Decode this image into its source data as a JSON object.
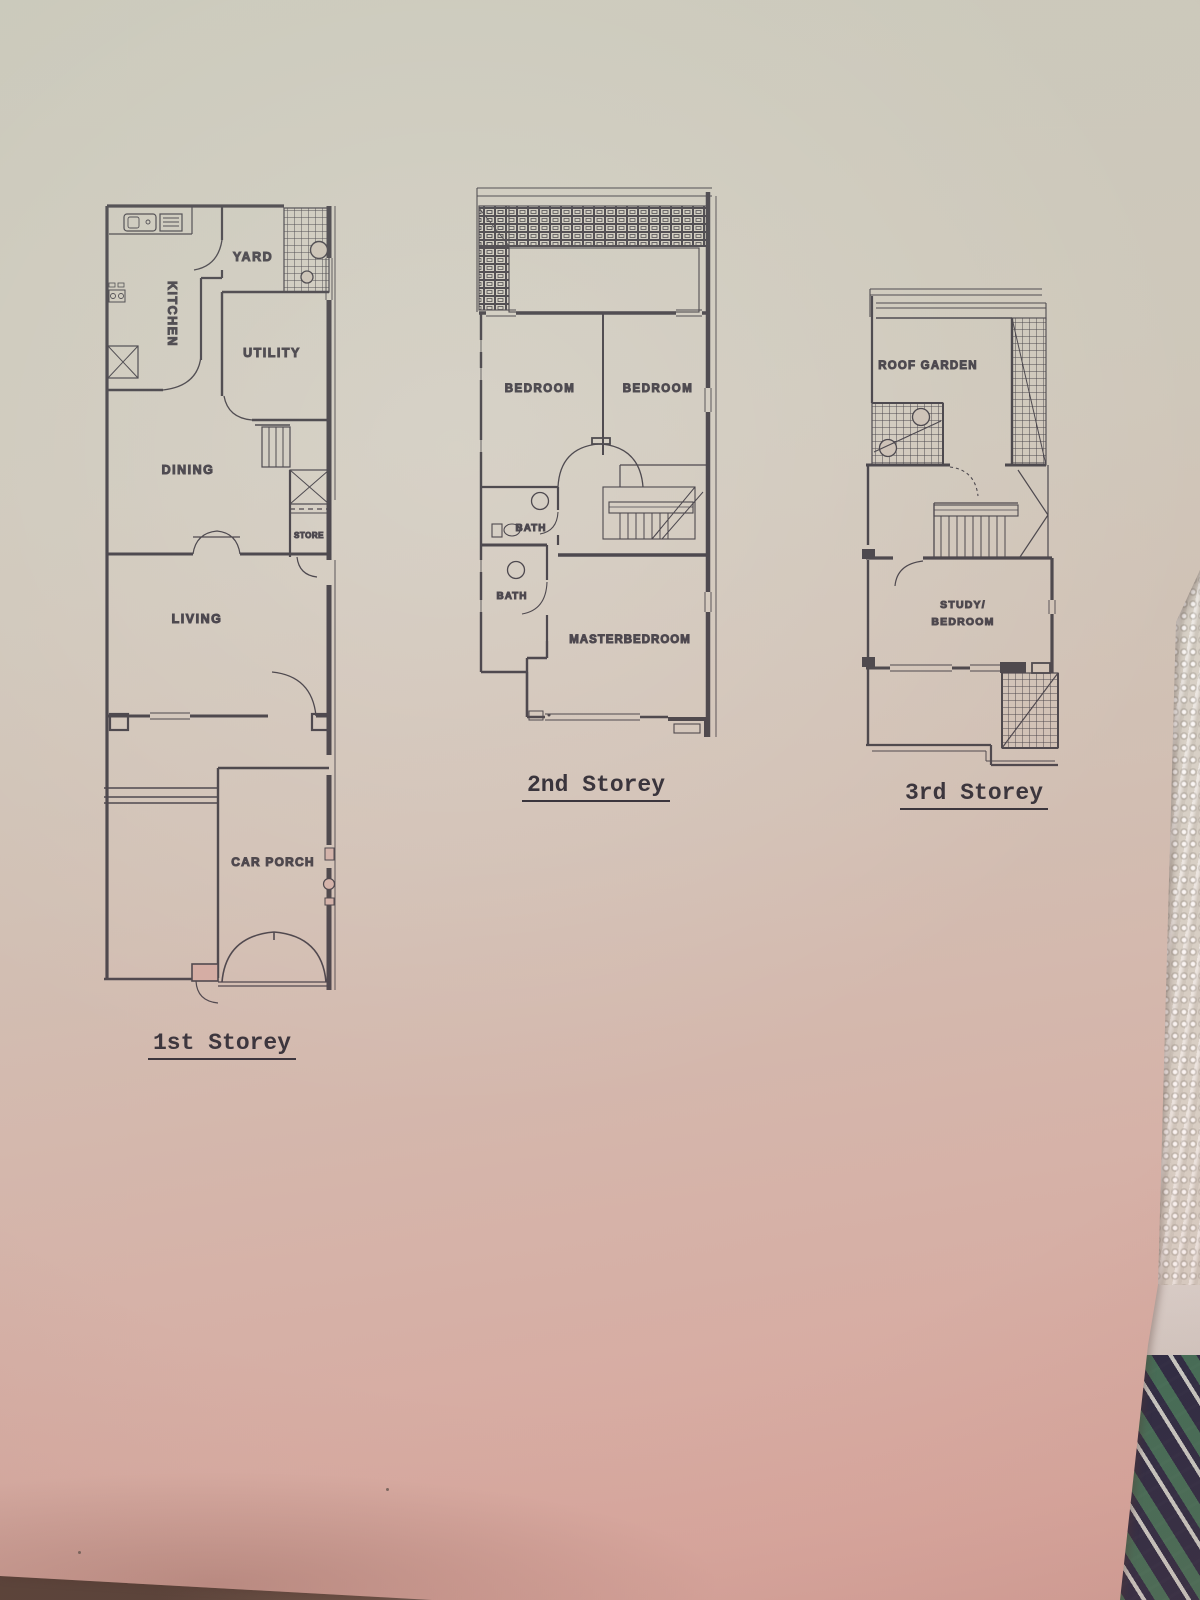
{
  "storeys": {
    "first": {
      "label": "1st Storey",
      "rooms": {
        "kitchen": "KITCHEN",
        "yard": "YARD",
        "utility": "UTILITY",
        "dining": "DINING",
        "store": "STORE",
        "living": "LIVING",
        "car_porch": "CAR PORCH"
      }
    },
    "second": {
      "label": "2nd Storey",
      "rooms": {
        "bedroom_left": "BEDROOM",
        "bedroom_right": "BEDROOM",
        "bath_upper": "BATH",
        "bath_lower": "BATH",
        "master": "MASTERBEDROOM"
      }
    },
    "third": {
      "label": "3rd Storey",
      "rooms": {
        "roof_garden": "ROOF GARDEN",
        "study_line1": "STUDY/",
        "study_line2": "BEDROOM"
      }
    }
  },
  "colors": {
    "ink": "#3a3740",
    "paper_top": "#cecbbe",
    "paper_mid": "#d1c2b6",
    "paper_bottom": "#d7aba2",
    "lace_fabric": "#d8d4ca",
    "plaid_navy": "#222f52",
    "plaid_green": "#2f6b50",
    "plaid_white": "#d3ded6",
    "table": "#46382f"
  }
}
